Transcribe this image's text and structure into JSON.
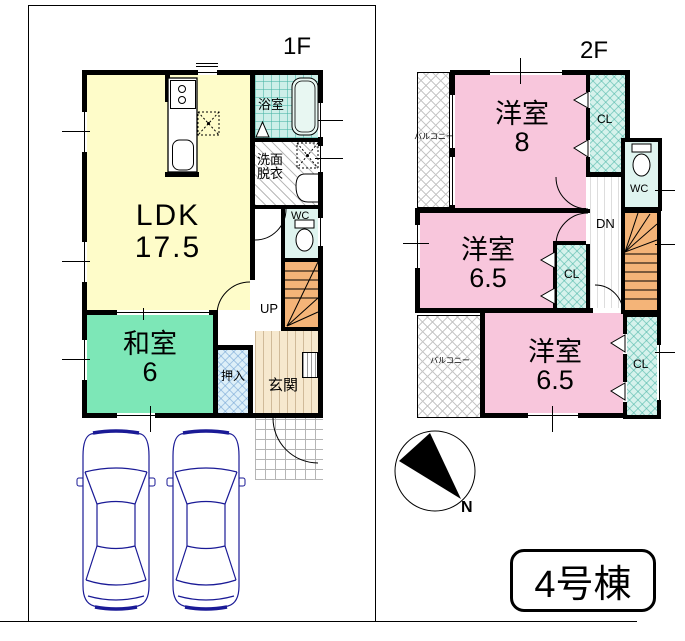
{
  "floor1": {
    "label": "1F",
    "rooms": {
      "ldk": {
        "name": "LDK",
        "size": "17.5"
      },
      "washitsu": {
        "name": "和室",
        "size": "6"
      },
      "oshiire": "押入",
      "genkan": "玄関",
      "bath": "浴室",
      "senmen_line1": "洗面",
      "senmen_line2": "脱衣",
      "wc": "WC",
      "up": "UP"
    }
  },
  "floor2": {
    "label": "2F",
    "rooms": {
      "room8": {
        "name": "洋室",
        "size": "8"
      },
      "room65a": {
        "name": "洋室",
        "size": "6.5"
      },
      "room65b": {
        "name": "洋室",
        "size": "6.5"
      },
      "cl_top": "CL",
      "cl_mid": "CL",
      "cl_bottom": "CL",
      "wc": "WC",
      "dn": "DN",
      "balcony_top": "バルコニー",
      "balcony_bottom": "バルコニー"
    }
  },
  "compass": {
    "north": "N"
  },
  "badge": {
    "label": "4号棟"
  },
  "colors": {
    "ldk_yellow": "#FEFCC9",
    "tatami_green": "#7DE7B7",
    "western_pink": "#F8C6DC",
    "stairs_orange": "#F4B478",
    "closet_teal": "#D6F2EC",
    "oshiire_blue": "#DDEFF8",
    "genkan_beige": "#F6E8CE",
    "car_navy": "#1A1A96",
    "wall_black": "#000000"
  }
}
